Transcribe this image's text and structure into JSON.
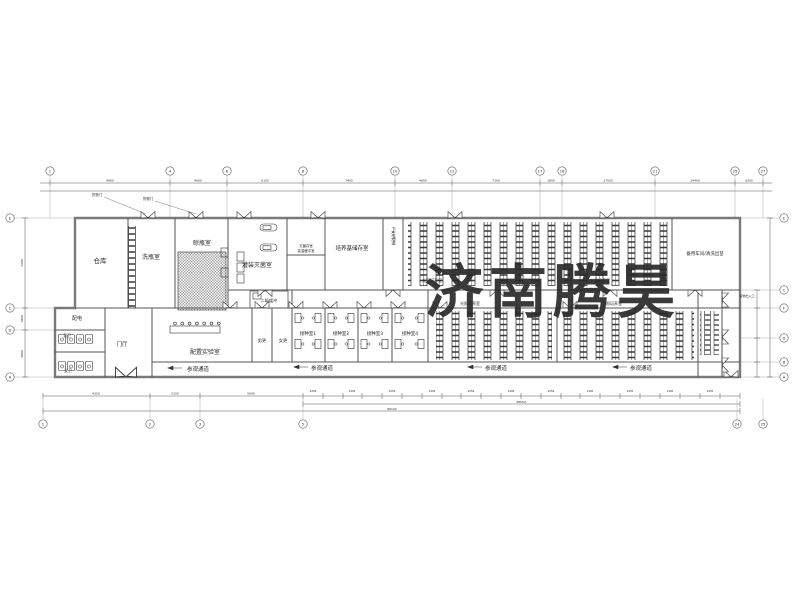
{
  "watermark": {
    "text": "济南腾昊",
    "color": "#e23338"
  },
  "rooms": {
    "warehouse": "仓库",
    "bottle_washing": "洗瓶室",
    "bottle_drying": "晾瓶室",
    "filling": "灌装灭菌室",
    "sterile_storage": "灭菌存室",
    "high_temp_buffer": "高温缓冲室",
    "medium_storage": "培养基储存室",
    "hygiene_passage": "卫生通道",
    "light_culture": "光照培养室",
    "spare_workshop": "备用车间/清洗出苗",
    "secondary_buffer": "二级缓冲",
    "prep_lab": "配置实验室",
    "mens_changing": "男更",
    "womens_changing": "女更",
    "inoculation_1": "接种室1",
    "inoculation_2": "接种室2",
    "inoculation_3": "接种室3",
    "inoculation_4": "接种室4",
    "visitor_passage": "参观通道",
    "power": "配电",
    "mens_wc": "男卫",
    "womens_wc": "女卫",
    "hall": "门厅",
    "cargo_door": "货物门",
    "cargo_exit": "货物出入口"
  },
  "grid": {
    "top": [
      "1",
      "4",
      "6",
      "8",
      "10",
      "12",
      "17",
      "18",
      "21",
      "25",
      "27"
    ],
    "bottom": [
      "1",
      "2",
      "3",
      "5",
      "24",
      "25"
    ],
    "left": [
      "E",
      "C",
      "D",
      "A"
    ],
    "right": [
      "E",
      "C",
      "F",
      "D",
      "B",
      "A"
    ]
  },
  "dims": {
    "top": [
      "9800",
      "4600",
      "6100",
      "7400",
      "4600",
      "7100",
      "1800",
      "17500",
      "14400",
      "8300"
    ],
    "annex": [
      "4350",
      "2100",
      "5600"
    ],
    "seg_a": "2250",
    "seg_b": "1400",
    "sub": "48552",
    "total": "66102",
    "left": [
      "7200",
      "1800",
      "4800"
    ]
  }
}
